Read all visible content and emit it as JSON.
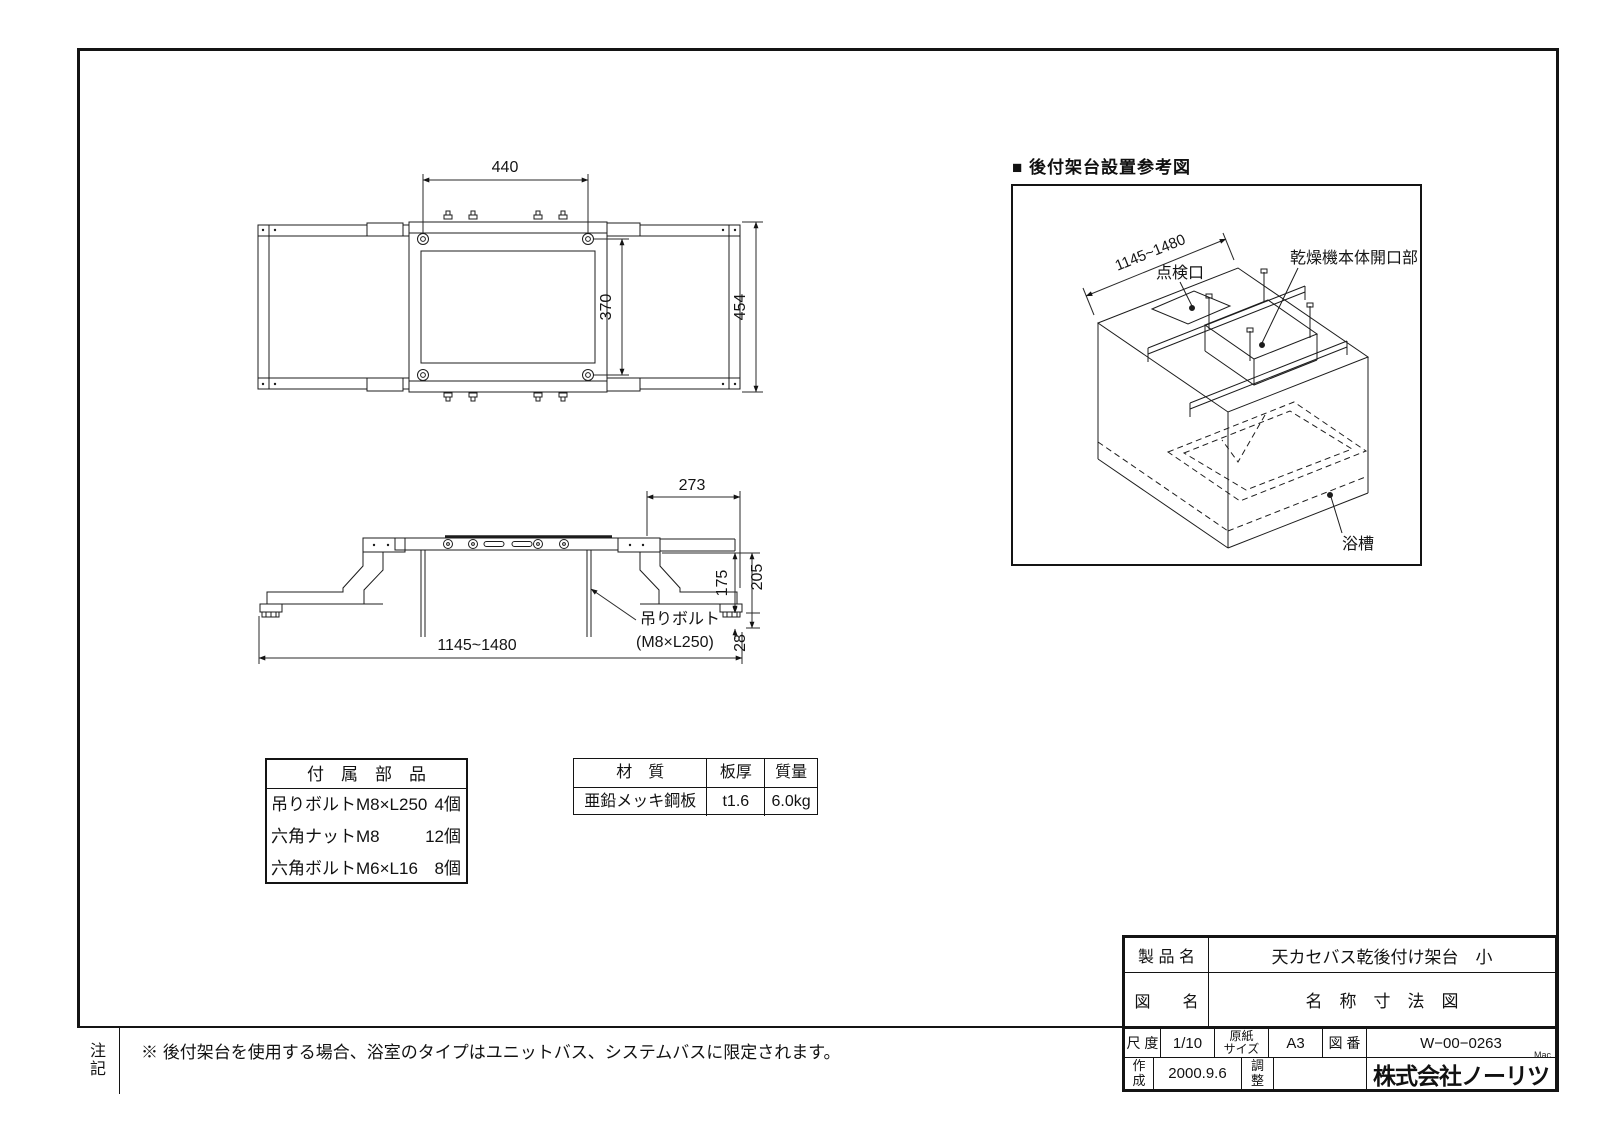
{
  "top_view": {
    "dims": {
      "width": "440",
      "inner_height": "370",
      "overall_height": "454"
    }
  },
  "side_view": {
    "dims": {
      "right_top": "273",
      "right_inner": "175",
      "right_outer": "205",
      "bottom_small": "28",
      "overall": "1145~1480"
    },
    "labels": {
      "bolt": "吊りボルト",
      "bolt_spec": "(M8×L250)"
    }
  },
  "iso": {
    "title": "■ 後付架台設置参考図",
    "dim_width": "1145~1480",
    "label_inspection": "点検口",
    "label_dryer_opening": "乾燥機本体開口部",
    "label_bathtub": "浴槽"
  },
  "parts": {
    "header": "付　属　部　品",
    "rows": [
      {
        "name": "吊りボルトM8×L250",
        "qty": "4個"
      },
      {
        "name": "六角ナットM8",
        "qty": "12個"
      },
      {
        "name": "六角ボルトM6×L16",
        "qty": "8個"
      }
    ]
  },
  "material": {
    "col_material": "材　質",
    "col_thickness": "板厚",
    "col_mass": "質量",
    "material": "亜鉛メッキ鋼板",
    "thickness": "t1.6",
    "mass": "6.0kg"
  },
  "title_block": {
    "product_label": "製 品 名",
    "product": "天カセバス乾後付け架台　小",
    "name_label": "図　　名",
    "name": "名　称　寸　法　図",
    "scale_label": "尺 度",
    "scale": "1/10",
    "paper_label": "原紙\nサイズ",
    "paper": "A3",
    "no_label": "図 番",
    "no": "W−00−0263",
    "made_label": "作\n成",
    "made": "2000.9.6",
    "adjust_label": "調\n整",
    "company": "株式会社ノーリツ",
    "mac": "Mac"
  },
  "note": {
    "label": "注\n記",
    "text": "※ 後付架台を使用する場合、浴室のタイプはユニットバス、システムバスに限定されます。"
  }
}
